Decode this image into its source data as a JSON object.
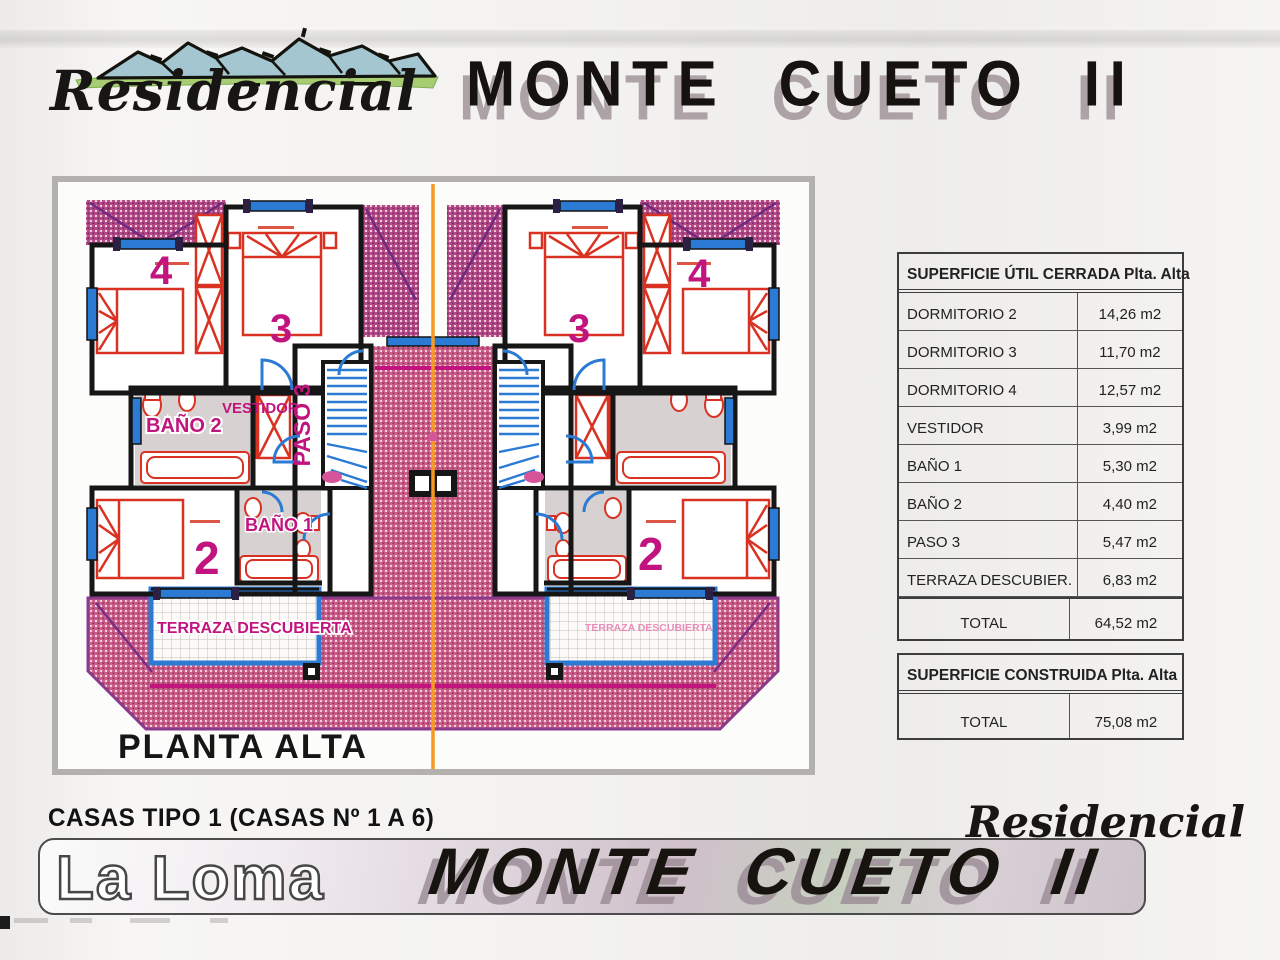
{
  "header": {
    "brand": "Residencial",
    "title": "MONTE CUETO II",
    "logo": "mountain landscape sketch"
  },
  "plan": {
    "title": "PLANTA ALTA",
    "labels": {
      "dorm4": "4",
      "dorm3": "3",
      "dorm2": "2",
      "bano1": "BAÑO 1",
      "bano2": "BAÑO 2",
      "vestidor": "VESTIDOR",
      "paso3": "PASO 3",
      "terraza": "TERRAZA DESCUBIERTA"
    },
    "colors": {
      "roof_pink": "#cb5f8a",
      "roof_purple": "#6f2a80",
      "wall_black": "#161616",
      "fixture_red": "#d93222",
      "window_blue": "#2b7bd4",
      "label_magenta": "#c2147e",
      "divider_orange": "#f5991f"
    }
  },
  "tables": {
    "util": {
      "title": "SUPERFICIE ÚTIL CERRADA Plta. Alta",
      "rows": [
        {
          "label": "DORMITORIO 2",
          "value": "14,26 m2"
        },
        {
          "label": "DORMITORIO 3",
          "value": "11,70 m2"
        },
        {
          "label": "DORMITORIO 4",
          "value": "12,57 m2"
        },
        {
          "label": "VESTIDOR",
          "value": "3,99 m2"
        },
        {
          "label": "BAÑO 1",
          "value": "5,30 m2"
        },
        {
          "label": "BAÑO 2",
          "value": "4,40 m2"
        },
        {
          "label": "PASO 3",
          "value": "5,47 m2"
        },
        {
          "label": "TERRAZA DESCUBIER.",
          "value": "6,83 m2"
        }
      ],
      "total_label": "TOTAL",
      "total_value": "64,52 m2"
    },
    "construida": {
      "title": "SUPERFICIE CONSTRUIDA Plta. Alta",
      "total_label": "TOTAL",
      "total_value": "75,08 m2"
    }
  },
  "footer": {
    "type_line": "CASAS TIPO 1 (CASAS Nº 1 A 6)",
    "location": "La Loma",
    "brand": "Residencial",
    "title": "MONTE CUETO II"
  }
}
